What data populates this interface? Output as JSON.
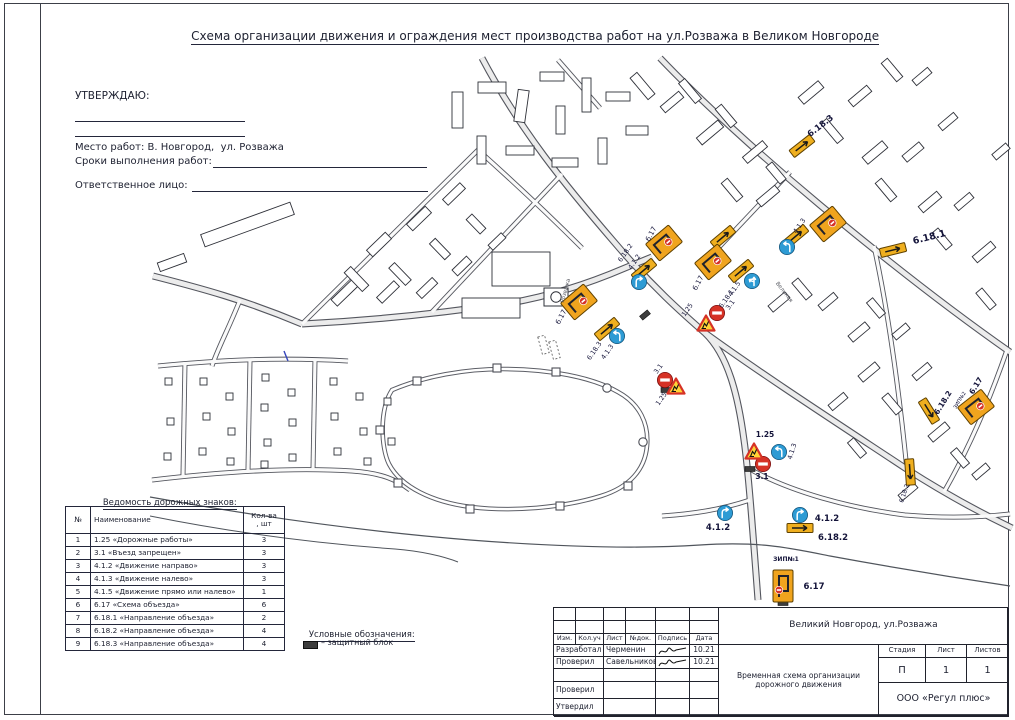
{
  "colors": {
    "sign_orange": "#F0A41E",
    "sign_yellow": "#EFAF1F",
    "sign_blue": "#2D9BD4",
    "sign_red": "#D63226",
    "line": "#20222C"
  },
  "sheet_title": "Схема организации движения и ограждения мест производства работ на ул.Розважа в Великом Новгороде",
  "approval": {
    "approve": "УТВЕРЖДАЮ:",
    "place": "Место работ: В. Новгород,  ул. Розважа",
    "terms": "Сроки выполнения работ:",
    "responsible": "Ответственное лицо:"
  },
  "signs_table": {
    "title": "Ведомость дорожных знаков:",
    "col_num": "№",
    "col_name": "Наименование",
    "col_qty1": "Кол-ва",
    "col_qty2": ", шт",
    "rows": [
      [
        "1",
        "1.25 «Дорожные работы»",
        "3"
      ],
      [
        "2",
        "3.1 «Въезд запрещен»",
        "3"
      ],
      [
        "3",
        "4.1.2 «Движение направо»",
        "3"
      ],
      [
        "4",
        "4.1.3 «Движение налево»",
        "3"
      ],
      [
        "5",
        "4.1.5 «Движение прямо или налево»",
        "1"
      ],
      [
        "6",
        "6.17 «Схема объезда»",
        "6"
      ],
      [
        "7",
        "6.18.1 «Направление объезда»",
        "2"
      ],
      [
        "8",
        "6.18.2 «Направление объезда»",
        "4"
      ],
      [
        "9",
        "6.18.3 «Направление объезда»",
        "4"
      ]
    ]
  },
  "legend": {
    "title": "Условные обозначения:",
    "item": "– защитный блок"
  },
  "title_block": {
    "object": "Великий Новгород, ул.Розважа",
    "doc_type": "Временная схема организации дорожного движения",
    "org": "ООО «Регул плюс»",
    "stage_label": "Стадия",
    "sheet_label": "Лист",
    "sheets_label": "Листов",
    "stage": "П",
    "sheet": "1",
    "sheets": "1",
    "cols": [
      "Изм.",
      "Кол.уч",
      "Лист",
      "№док.",
      "Подпись",
      "Дата"
    ],
    "rows": [
      {
        "role": "Разработал",
        "name": "Черменин",
        "date": "10.21"
      },
      {
        "role": "Проверил",
        "name": "Савельников",
        "date": "10.21"
      },
      {
        "role": "Проверил",
        "name": "",
        "date": ""
      },
      {
        "role": "Утвердил",
        "name": "",
        "date": ""
      }
    ]
  },
  "map": {
    "labels": [
      {
        "text": "6.18.3"
      },
      {
        "text": "6.18.1"
      },
      {
        "text": "6.17"
      },
      {
        "text": "4.1.5"
      },
      {
        "text": "6.18.1"
      },
      {
        "text": "4.1.3"
      },
      {
        "text": "3.1"
      },
      {
        "text": "1.25"
      },
      {
        "text": "6.17"
      },
      {
        "text": "6.18.2"
      },
      {
        "text": "4.1.2"
      },
      {
        "text": "6.17"
      },
      {
        "text": "6.18.3"
      },
      {
        "text": "4.1.3"
      },
      {
        "text": "3.1"
      },
      {
        "text": "1.25"
      },
      {
        "text": "1.25"
      },
      {
        "text": "3.1"
      },
      {
        "text": "4.1.3"
      },
      {
        "text": "4.1.2"
      },
      {
        "text": "4.1.2"
      },
      {
        "text": "6.18.2"
      },
      {
        "text": "6.17"
      },
      {
        "text": "ЗИП№1"
      },
      {
        "text": "6.17"
      },
      {
        "text": "ЗИП№2"
      },
      {
        "text": "6.18.2"
      },
      {
        "text": "6.18.2"
      },
      {
        "text": "Розважа"
      },
      {
        "text": "Великая"
      }
    ]
  }
}
